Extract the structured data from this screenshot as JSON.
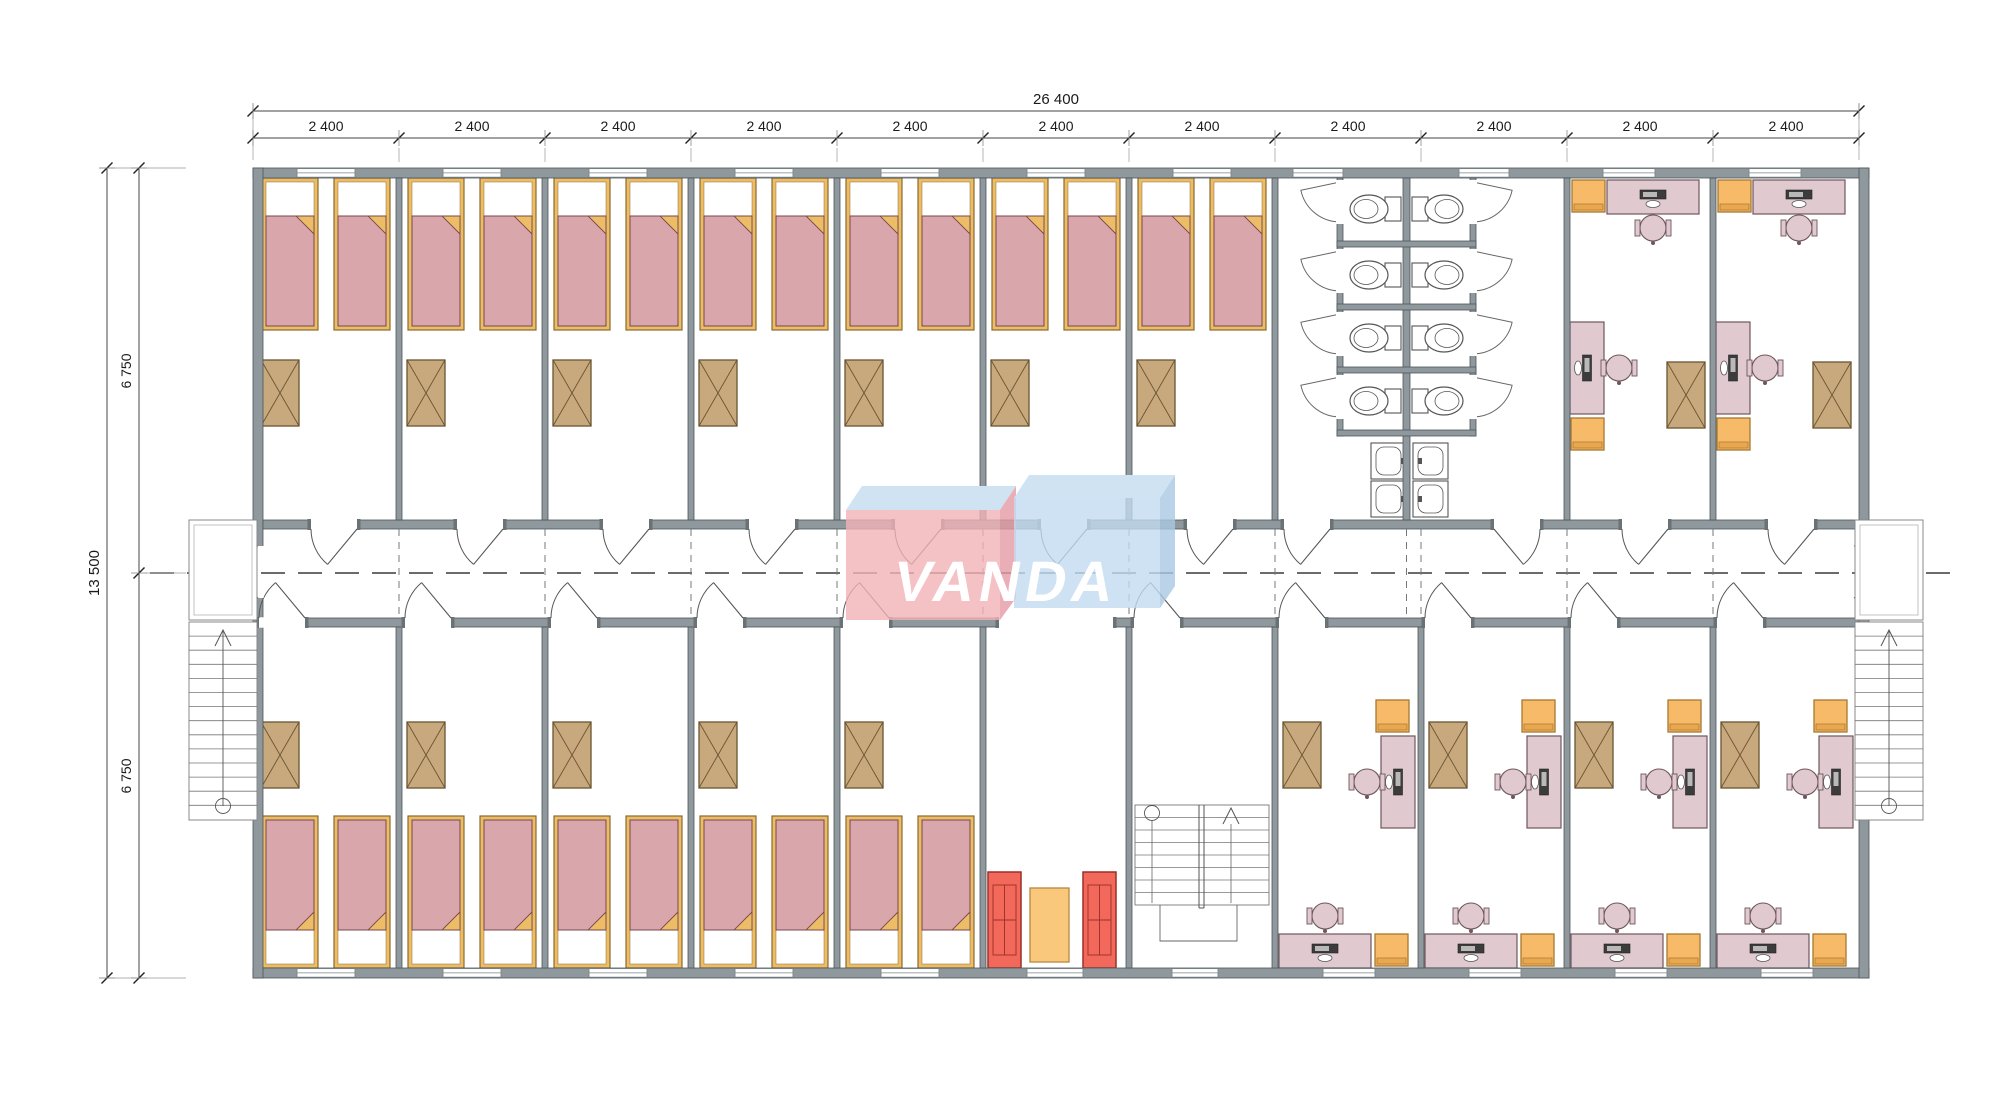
{
  "logo": {
    "text": "VANDA",
    "text_color": "#ffffff",
    "block_red": "#f1b1b7",
    "block_red_side": "#e59aa4",
    "block_blue": "#c2dbf0",
    "block_blue_side": "#a9c8e2",
    "top_face": "#cfe3f3",
    "opacity": 0.8
  },
  "dimensions": {
    "top_total": "26 400",
    "top_segments": [
      "2 400",
      "2 400",
      "2 400",
      "2 400",
      "2 400",
      "2 400",
      "2 400",
      "2 400",
      "2 400",
      "2 400",
      "2 400"
    ],
    "left_total": "13 500",
    "left_segments": [
      "6 750",
      "6 750"
    ]
  },
  "plan": {
    "counts": {
      "top_bedrooms": 7,
      "bottom_bedrooms": 5,
      "beds_per_bedroom": 2,
      "toilet_stall_rows": 4,
      "toilets": 8,
      "sink_pairs": 2,
      "top_offices": 2,
      "bottom_offices": 4,
      "sofas": 2,
      "external_stairs": 2,
      "internal_stairs": 1
    },
    "colors": {
      "wall": "#8f999d",
      "wall_edge": "#4d565a",
      "wall_cap": "#6a7276",
      "bed_frame": "#ecbd66",
      "bed_frame_edge": "#8a6a2e",
      "blanket": "#d9a6ab",
      "blanket_edge": "#77474d",
      "wardrobe": "#c8a97e",
      "wardrobe_edge": "#6a5430",
      "desk": "#e0cad0",
      "desk_edge": "#6e565c",
      "chair_orange": "#f6ba68",
      "chair_orange_edge": "#a8782f",
      "chair_orange_band": "#e9a74f",
      "sofa": "#f2695c",
      "sofa_edge": "#9c2f26",
      "table": "#f9c87d",
      "table_edge": "#b5873f",
      "monitor": "#3c3c3c",
      "fixture": "#ffffff",
      "fixture_edge": "#555555",
      "stair_line": "#777777",
      "dash_line": "#3a3a3a",
      "dim_line": "#444444",
      "dim_text": "#1a1a1a",
      "ext_line": "#999999"
    }
  }
}
